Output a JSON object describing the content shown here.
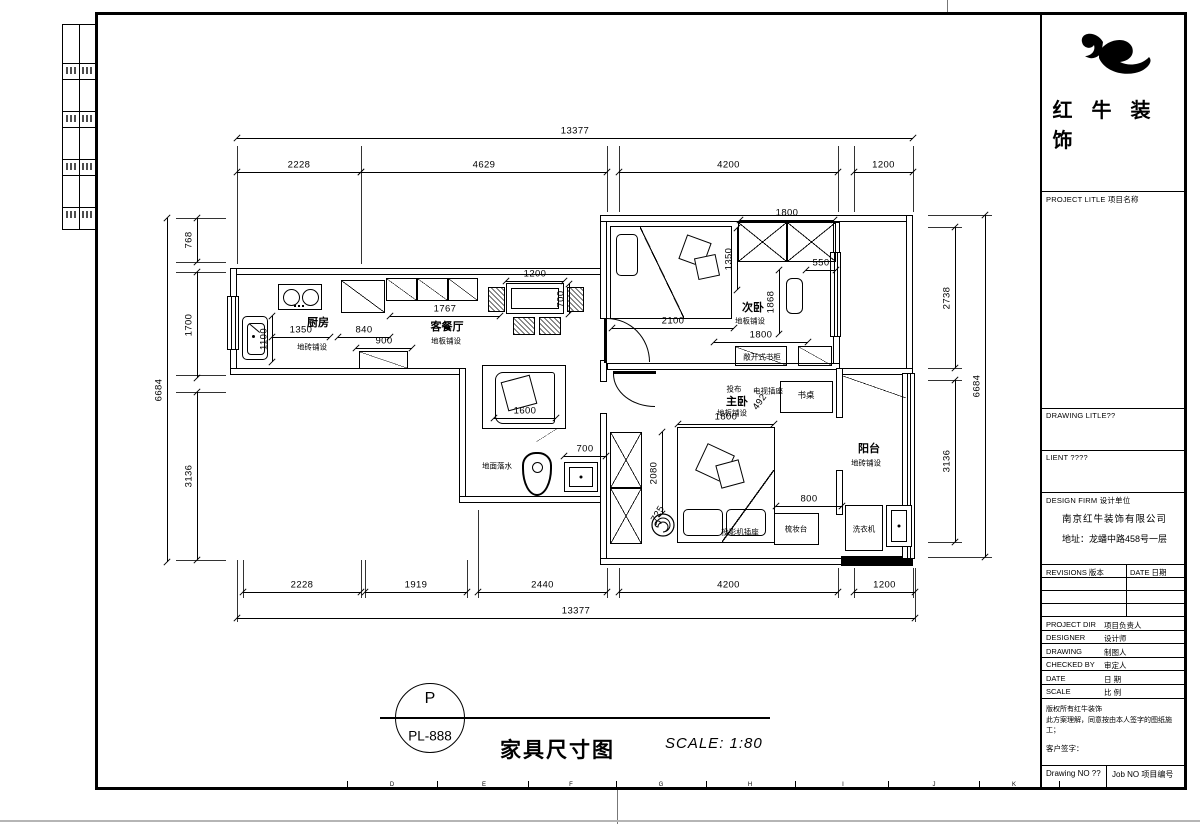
{
  "sheet": {
    "brand": "红牛装饰",
    "project_label": "PROJECT LITLE 项目名称",
    "drawing_label": "DRAWING LITLE??",
    "client_label": "LIENT ????",
    "firm_label": "DESIGN FIRM 设计单位",
    "firm_name": "南京红牛装饰有限公司",
    "firm_addr": "地址：龙蟠中路458号一层",
    "rev_label": "REVISIONS 版本",
    "date_label": "DATE 日期",
    "rows": [
      {
        "en": "PROJECT DIR",
        "cn": "项目负责人"
      },
      {
        "en": "DESIGNER",
        "cn": "设计师"
      },
      {
        "en": "DRAWING",
        "cn": "制图人"
      },
      {
        "en": "CHECKED BY",
        "cn": "审定人"
      },
      {
        "en": "DATE",
        "cn": "日 期"
      },
      {
        "en": "SCALE",
        "cn": "比 例"
      }
    ],
    "note1": "版权所有红牛装饰",
    "note2": "此方案理解，同意按由本人签字的图纸施工；",
    "note3": "客户签字：",
    "drawing_no": "Drawing NO ??",
    "job_no": "Job NO 项目编号",
    "footer": {
      "mark": "P",
      "num": "PL-888",
      "title": "家具尺寸图",
      "scale": "SCALE: 1:80"
    },
    "grid_letters": [
      {
        "t": "D",
        "x": 392
      },
      {
        "t": "E",
        "x": 484
      },
      {
        "t": "F",
        "x": 571
      },
      {
        "t": "G",
        "x": 661
      },
      {
        "t": "H",
        "x": 750
      },
      {
        "t": "I",
        "x": 843
      },
      {
        "t": "J",
        "x": 934
      },
      {
        "t": "K",
        "x": 1014
      }
    ],
    "grid_ticks": [
      347,
      437,
      528,
      616,
      706,
      795,
      888,
      979,
      1059
    ]
  },
  "plan": {
    "walls": [
      {
        "n": "wall-top-left",
        "x": 230,
        "y": 268,
        "w": 377,
        "h": 7
      },
      {
        "n": "wall-left",
        "x": 230,
        "y": 268,
        "w": 7,
        "h": 107
      },
      {
        "n": "wall-kitchen-bottom",
        "x": 230,
        "y": 368,
        "w": 236,
        "h": 7
      },
      {
        "n": "wall-bath-left",
        "x": 459,
        "y": 368,
        "w": 7,
        "h": 135
      },
      {
        "n": "wall-bath-bottom",
        "x": 459,
        "y": 496,
        "w": 148,
        "h": 7
      },
      {
        "n": "wall-corridor-a",
        "x": 600,
        "y": 215,
        "w": 7,
        "h": 104
      },
      {
        "n": "wall-corridor-b",
        "x": 600,
        "y": 360,
        "w": 7,
        "h": 22
      },
      {
        "n": "wall-corridor-c",
        "x": 600,
        "y": 413,
        "w": 7,
        "h": 152
      },
      {
        "n": "wall-top-right",
        "x": 600,
        "y": 215,
        "w": 313,
        "h": 7
      },
      {
        "n": "wall-right-upper",
        "x": 906,
        "y": 215,
        "w": 7,
        "h": 160
      },
      {
        "n": "wall-bedroom2-right",
        "x": 833,
        "y": 222,
        "w": 7,
        "h": 148
      },
      {
        "n": "wall-bed-divider",
        "x": 607,
        "y": 363,
        "w": 233,
        "h": 7
      },
      {
        "n": "wall-balcony-top",
        "x": 836,
        "y": 368,
        "w": 77,
        "h": 7
      },
      {
        "n": "wall-balcony-left-a",
        "x": 836,
        "y": 368,
        "w": 7,
        "h": 50
      },
      {
        "n": "wall-balcony-left-b",
        "x": 836,
        "y": 470,
        "w": 7,
        "h": 45
      },
      {
        "n": "wall-bottom-right",
        "x": 600,
        "y": 558,
        "w": 313,
        "h": 7
      },
      {
        "n": "wall-balcony-bottom-cut",
        "x": 841,
        "y": 556,
        "w": 72,
        "h": 10,
        "black": 1
      }
    ],
    "windows": [
      {
        "n": "window-kitchen",
        "x": 227,
        "y": 296,
        "w": 12,
        "h": 54
      },
      {
        "n": "window-bedroom2",
        "x": 830,
        "y": 252,
        "w": 11,
        "h": 85
      },
      {
        "n": "window-balcony",
        "x": 902,
        "y": 373,
        "w": 13,
        "h": 186
      }
    ],
    "doors": [
      {
        "n": "door-bedroom2",
        "x": 607,
        "y": 318,
        "w": 43,
        "h": 44,
        "c": "tr",
        "leaf": {
          "x": 604,
          "y": 318,
          "w": 3,
          "h": 45
        }
      },
      {
        "n": "door-bedroom1",
        "x": 613,
        "y": 374,
        "w": 42,
        "h": 33,
        "c": "bl",
        "leaf": {
          "x": 613,
          "y": 371,
          "w": 43,
          "h": 3
        }
      }
    ],
    "furn": [
      {
        "t": "diag",
        "d": 1,
        "n": "fridge",
        "x": 341,
        "y": 280,
        "w": 44,
        "h": 33
      },
      {
        "t": "diag",
        "d": 1,
        "n": "cabinet",
        "x": 386,
        "y": 278,
        "w": 31,
        "h": 23
      },
      {
        "t": "diag",
        "d": 1,
        "n": "cabinet",
        "x": 417,
        "y": 278,
        "w": 31,
        "h": 23
      },
      {
        "t": "diag",
        "d": 1,
        "n": "cabinet",
        "x": 448,
        "y": 278,
        "w": 30,
        "h": 23
      },
      {
        "t": "rect2",
        "n": "dining-table",
        "x": 506,
        "y": 283,
        "w": 58,
        "h": 31
      },
      {
        "t": "hatch",
        "n": "chair",
        "x": 488,
        "y": 287,
        "w": 17,
        "h": 25
      },
      {
        "t": "hatch",
        "n": "chair",
        "x": 567,
        "y": 287,
        "w": 17,
        "h": 25
      },
      {
        "t": "hatch",
        "n": "chair",
        "x": 513,
        "y": 317,
        "w": 22,
        "h": 18
      },
      {
        "t": "hatch",
        "n": "chair",
        "x": 539,
        "y": 317,
        "w": 22,
        "h": 18
      },
      {
        "t": "diag",
        "d": 1,
        "n": "tv-cabinet",
        "x": 359,
        "y": 351,
        "w": 49,
        "h": 18
      },
      {
        "t": "rect",
        "n": "bed-secondary",
        "x": 610,
        "y": 226,
        "w": 122,
        "h": 93
      },
      {
        "t": "pillow",
        "n": "pillow",
        "x": 616,
        "y": 234,
        "w": 22,
        "h": 42
      },
      {
        "t": "line",
        "d": -1,
        "n": "blanket-fold",
        "x": 640,
        "y": 227,
        "w": 44,
        "h": 91
      },
      {
        "t": "rot",
        "a": 20,
        "n": "blanket-decor",
        "x": 682,
        "y": 238,
        "w": 26,
        "h": 26
      },
      {
        "t": "rot",
        "a": -12,
        "n": "blanket-decor",
        "x": 696,
        "y": 256,
        "w": 22,
        "h": 22
      },
      {
        "t": "xbox",
        "n": "wardrobe",
        "x": 738,
        "y": 222,
        "w": 49,
        "h": 40
      },
      {
        "t": "xbox",
        "n": "wardrobe",
        "x": 787,
        "y": 222,
        "w": 49,
        "h": 40
      },
      {
        "t": "rect",
        "r": 6,
        "n": "small-cabinet",
        "x": 786,
        "y": 278,
        "w": 17,
        "h": 36
      },
      {
        "t": "diag",
        "d": 1,
        "n": "open-bookcase",
        "x": 735,
        "y": 346,
        "w": 52,
        "h": 20
      },
      {
        "t": "diag",
        "d": 1,
        "n": "open-bookcase",
        "x": 798,
        "y": 346,
        "w": 34,
        "h": 20
      },
      {
        "t": "rect",
        "n": "bed-master",
        "x": 677,
        "y": 427,
        "w": 98,
        "h": 116
      },
      {
        "t": "pillow",
        "n": "pillow",
        "x": 683,
        "y": 509,
        "w": 40,
        "h": 27
      },
      {
        "t": "pillow",
        "n": "pillow",
        "x": 726,
        "y": 509,
        "w": 40,
        "h": 27
      },
      {
        "t": "line",
        "d": 1,
        "n": "blanket-fold",
        "x": 722,
        "y": 470,
        "w": 52,
        "h": 72
      },
      {
        "t": "rot",
        "a": 25,
        "n": "blanket-decor",
        "x": 700,
        "y": 448,
        "w": 30,
        "h": 30
      },
      {
        "t": "rot",
        "a": -15,
        "n": "blanket-decor",
        "x": 718,
        "y": 462,
        "w": 24,
        "h": 24
      },
      {
        "t": "xbox",
        "n": "wardrobe",
        "x": 610,
        "y": 432,
        "w": 32,
        "h": 56
      },
      {
        "t": "xbox",
        "n": "wardrobe",
        "x": 610,
        "y": 488,
        "w": 32,
        "h": 56
      },
      {
        "t": "rect",
        "n": "desk",
        "x": 780,
        "y": 381,
        "w": 53,
        "h": 32
      },
      {
        "t": "rect",
        "n": "dresser",
        "x": 774,
        "y": 513,
        "w": 45,
        "h": 32
      },
      {
        "t": "rect2",
        "dot": 1,
        "n": "shower-drain",
        "x": 564,
        "y": 462,
        "w": 34,
        "h": 30
      },
      {
        "t": "line",
        "d": 1,
        "n": "bath-door-leaf",
        "x": 536,
        "y": 428,
        "w": 22,
        "h": 14
      },
      {
        "t": "rect",
        "n": "washing-machine",
        "x": 845,
        "y": 505,
        "w": 38,
        "h": 46
      },
      {
        "t": "rect2",
        "dot": 1,
        "n": "floor-drain",
        "x": 886,
        "y": 505,
        "w": 26,
        "h": 42
      },
      {
        "t": "line",
        "d": -1,
        "n": "sliding-panel",
        "x": 843,
        "y": 376,
        "w": 63,
        "h": 22
      }
    ],
    "dims": [
      {
        "t": "13377",
        "d": "h",
        "x": 237,
        "y": 138,
        "l": 676
      },
      {
        "t": "2228",
        "d": "h",
        "x": 237,
        "y": 172,
        "l": 124
      },
      {
        "t": "4629",
        "d": "h",
        "x": 361,
        "y": 172,
        "l": 246
      },
      {
        "t": "4200",
        "d": "h",
        "x": 619,
        "y": 172,
        "l": 219
      },
      {
        "t": "1200",
        "d": "h",
        "x": 854,
        "y": 172,
        "l": 59
      },
      {
        "t": "2228",
        "d": "h",
        "x": 243,
        "y": 592,
        "l": 118
      },
      {
        "t": "1919",
        "d": "h",
        "x": 365,
        "y": 592,
        "l": 102
      },
      {
        "t": "2440",
        "d": "h",
        "x": 478,
        "y": 592,
        "l": 129
      },
      {
        "t": "4200",
        "d": "h",
        "x": 619,
        "y": 592,
        "l": 219
      },
      {
        "t": "1200",
        "d": "h",
        "x": 854,
        "y": 592,
        "l": 61
      },
      {
        "t": "13377",
        "d": "h",
        "x": 237,
        "y": 618,
        "l": 678
      },
      {
        "t": "6684",
        "d": "v",
        "x": 167,
        "y": 218,
        "l": 344
      },
      {
        "t": "768",
        "d": "v",
        "x": 197,
        "y": 218,
        "l": 44
      },
      {
        "t": "1700",
        "d": "v",
        "x": 197,
        "y": 272,
        "l": 106
      },
      {
        "t": "3136",
        "d": "v",
        "x": 197,
        "y": 392,
        "l": 168
      },
      {
        "t": "2738",
        "d": "v",
        "x": 955,
        "y": 227,
        "l": 141
      },
      {
        "t": "3136",
        "d": "v",
        "x": 955,
        "y": 380,
        "l": 162
      },
      {
        "t": "6684",
        "d": "v",
        "x": 985,
        "y": 215,
        "l": 342
      },
      {
        "t": "1767",
        "d": "h",
        "x": 390,
        "y": 316,
        "l": 110
      },
      {
        "t": "1350",
        "d": "h",
        "x": 272,
        "y": 337,
        "l": 58
      },
      {
        "t": "840",
        "d": "h",
        "x": 338,
        "y": 337,
        "l": 52
      },
      {
        "t": "900",
        "d": "h",
        "x": 356,
        "y": 348,
        "l": 56
      },
      {
        "t": "1100",
        "d": "v",
        "x": 272,
        "y": 316,
        "l": 46
      },
      {
        "t": "1200",
        "d": "h",
        "x": 506,
        "y": 281,
        "l": 58
      },
      {
        "t": "700",
        "d": "v",
        "x": 569,
        "y": 284,
        "l": 30
      },
      {
        "t": "1600",
        "d": "h",
        "x": 494,
        "y": 418,
        "l": 62
      },
      {
        "t": "2100",
        "d": "h",
        "x": 612,
        "y": 328,
        "l": 122
      },
      {
        "t": "1800",
        "d": "h",
        "x": 740,
        "y": 220,
        "l": 94
      },
      {
        "t": "1350",
        "d": "v",
        "x": 737,
        "y": 228,
        "l": 62
      },
      {
        "t": "550",
        "d": "h",
        "x": 806,
        "y": 270,
        "l": 30
      },
      {
        "t": "1868",
        "d": "v",
        "x": 779,
        "y": 270,
        "l": 64
      },
      {
        "t": "1800",
        "d": "h",
        "x": 714,
        "y": 342,
        "l": 94
      },
      {
        "t": "1800",
        "d": "h",
        "x": 678,
        "y": 424,
        "l": 96
      },
      {
        "t": "2080",
        "d": "v",
        "x": 662,
        "y": 432,
        "l": 82
      },
      {
        "t": "800",
        "d": "h",
        "x": 776,
        "y": 506,
        "l": 66
      },
      {
        "t": "700",
        "d": "h",
        "x": 564,
        "y": 456,
        "l": 42
      },
      {
        "t": "492",
        "rot": -55,
        "x": 760,
        "y": 402,
        "lo": 1
      },
      {
        "t": "725",
        "rot": -60,
        "x": 658,
        "y": 514,
        "lo": 1
      }
    ],
    "ext": [
      {
        "d": "v",
        "x": 237,
        "y": 146,
        "l": 118
      },
      {
        "d": "v",
        "x": 361,
        "y": 146,
        "l": 118
      },
      {
        "d": "v",
        "x": 607,
        "y": 146,
        "l": 66
      },
      {
        "d": "v",
        "x": 619,
        "y": 146,
        "l": 66
      },
      {
        "d": "v",
        "x": 838,
        "y": 146,
        "l": 66
      },
      {
        "d": "v",
        "x": 854,
        "y": 146,
        "l": 66
      },
      {
        "d": "v",
        "x": 913,
        "y": 146,
        "l": 66
      },
      {
        "d": "v",
        "x": 243,
        "y": 560,
        "l": 38
      },
      {
        "d": "v",
        "x": 361,
        "y": 560,
        "l": 38
      },
      {
        "d": "v",
        "x": 365,
        "y": 560,
        "l": 38
      },
      {
        "d": "v",
        "x": 467,
        "y": 560,
        "l": 38
      },
      {
        "d": "v",
        "x": 478,
        "y": 510,
        "l": 88
      },
      {
        "d": "v",
        "x": 607,
        "y": 568,
        "l": 30
      },
      {
        "d": "v",
        "x": 619,
        "y": 568,
        "l": 30
      },
      {
        "d": "v",
        "x": 838,
        "y": 568,
        "l": 30
      },
      {
        "d": "v",
        "x": 854,
        "y": 568,
        "l": 30
      },
      {
        "d": "v",
        "x": 913,
        "y": 568,
        "l": 30
      },
      {
        "d": "v",
        "x": 237,
        "y": 560,
        "l": 62
      },
      {
        "d": "v",
        "x": 915,
        "y": 568,
        "l": 54
      },
      {
        "d": "h",
        "x": 176,
        "y": 218,
        "l": 50
      },
      {
        "d": "h",
        "x": 176,
        "y": 262,
        "l": 50
      },
      {
        "d": "h",
        "x": 176,
        "y": 272,
        "l": 50
      },
      {
        "d": "h",
        "x": 176,
        "y": 375,
        "l": 50
      },
      {
        "d": "h",
        "x": 176,
        "y": 392,
        "l": 50
      },
      {
        "d": "h",
        "x": 176,
        "y": 560,
        "l": 50
      },
      {
        "d": "h",
        "x": 928,
        "y": 215,
        "l": 64
      },
      {
        "d": "h",
        "x": 928,
        "y": 227,
        "l": 34
      },
      {
        "d": "h",
        "x": 928,
        "y": 368,
        "l": 34
      },
      {
        "d": "h",
        "x": 928,
        "y": 380,
        "l": 34
      },
      {
        "d": "h",
        "x": 928,
        "y": 542,
        "l": 34
      },
      {
        "d": "h",
        "x": 928,
        "y": 557,
        "l": 64
      }
    ],
    "labels": [
      {
        "t": "厨房",
        "x": 318,
        "y": 322,
        "fs": 11,
        "b": 1
      },
      {
        "t": "地砖铺设",
        "x": 312,
        "y": 347,
        "fs": 7.5
      },
      {
        "t": "客餐厅",
        "x": 447,
        "y": 326,
        "fs": 11,
        "b": 1
      },
      {
        "t": "地板铺设",
        "x": 446,
        "y": 341,
        "fs": 7.5
      },
      {
        "t": "次卧",
        "x": 753,
        "y": 307,
        "fs": 11,
        "b": 1
      },
      {
        "t": "地板铺设",
        "x": 750,
        "y": 321,
        "fs": 7.5
      },
      {
        "t": "主卧",
        "x": 737,
        "y": 401,
        "fs": 11,
        "b": 1
      },
      {
        "t": "地板铺设",
        "x": 732,
        "y": 413,
        "fs": 7.5
      },
      {
        "t": "投布",
        "x": 734,
        "y": 389,
        "fs": 7.5
      },
      {
        "t": "电视插座",
        "x": 768,
        "y": 391,
        "fs": 7.5
      },
      {
        "t": "书桌",
        "x": 806,
        "y": 395,
        "fs": 8.5
      },
      {
        "t": "阳台",
        "x": 869,
        "y": 448,
        "fs": 11,
        "b": 1
      },
      {
        "t": "地砖铺设",
        "x": 866,
        "y": 463,
        "fs": 7.5
      },
      {
        "t": "敞开式书柜",
        "x": 762,
        "y": 357,
        "fs": 7.5
      },
      {
        "t": "梳妆台",
        "x": 796,
        "y": 529,
        "fs": 7.5
      },
      {
        "t": "洗衣机",
        "x": 864,
        "y": 529,
        "fs": 7.5
      },
      {
        "t": "投影机插座",
        "x": 740,
        "y": 532,
        "fs": 7.5
      },
      {
        "t": "地面落水",
        "x": 497,
        "y": 466,
        "fs": 7.5
      }
    ]
  }
}
